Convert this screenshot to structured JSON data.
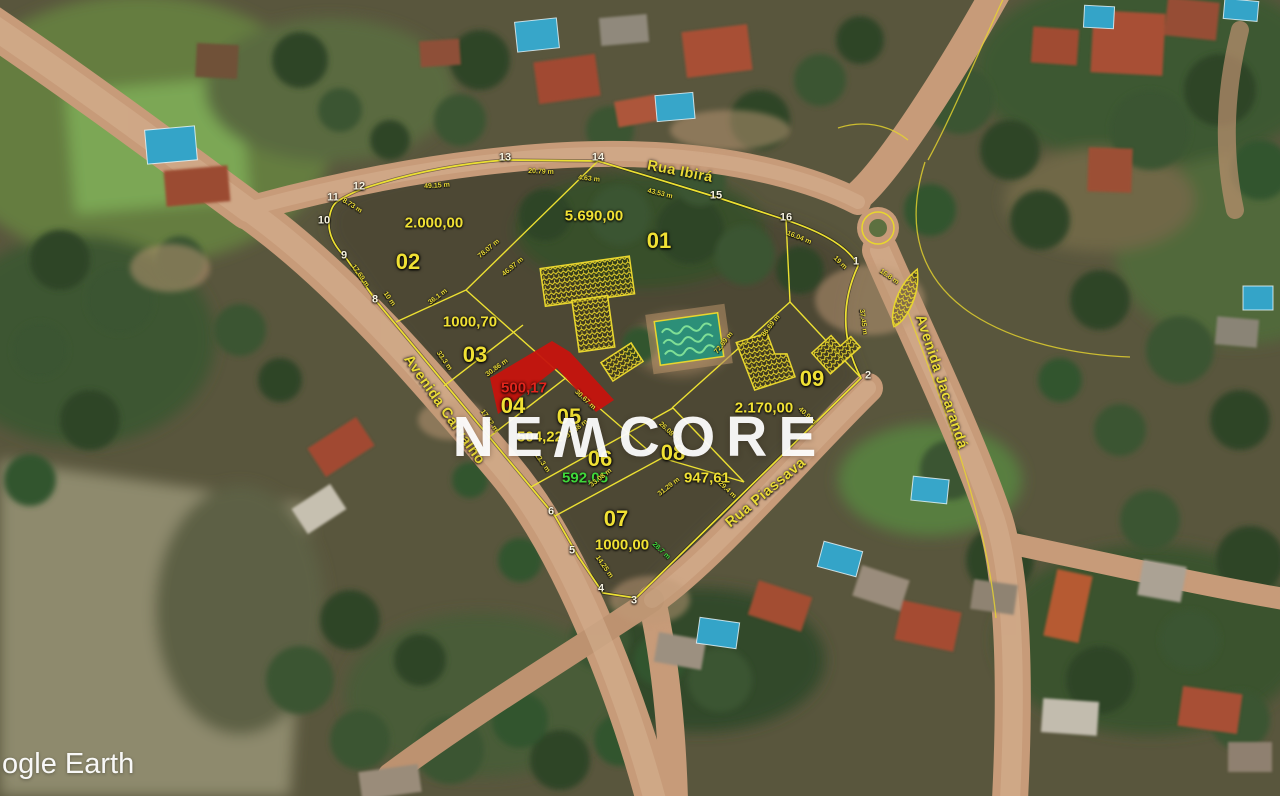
{
  "watermark": {
    "prefix": "NE",
    "flipped_letter": "W",
    "suffix": "CORE"
  },
  "attribution": {
    "logo_text": "ogle Earth"
  },
  "colors": {
    "lot_line": "#ece032",
    "lot_text": "#f0e134",
    "area_green": "#3fd83a",
    "area_red": "#e2251c",
    "highlight_red": "#c6140e",
    "street_text": "#e9da36"
  },
  "streets": [
    {
      "name": "Rua Ibirá",
      "x": 680,
      "y": 172,
      "rotation": 11
    },
    {
      "name": "Avenida Carvalho",
      "x": 444,
      "y": 410,
      "rotation": 55
    },
    {
      "name": "Avenida Jacarandá",
      "x": 941,
      "y": 382,
      "rotation": 72
    },
    {
      "name": "Rua Piassava",
      "x": 766,
      "y": 493,
      "rotation": -40
    }
  ],
  "lots": [
    {
      "number": "01",
      "area": "5.690,00",
      "number_pos": {
        "x": 659,
        "y": 241
      },
      "area_pos": {
        "x": 594,
        "y": 216
      },
      "area_color": "#f0e134"
    },
    {
      "number": "02",
      "area": "2.000,00",
      "number_pos": {
        "x": 408,
        "y": 262
      },
      "area_pos": {
        "x": 434,
        "y": 223
      },
      "area_color": "#f0e134"
    },
    {
      "number": "03",
      "area": "1000,70",
      "number_pos": {
        "x": 475,
        "y": 355
      },
      "area_pos": {
        "x": 470,
        "y": 322
      },
      "area_color": "#f0e134"
    },
    {
      "number": "04",
      "area": "500,17",
      "number_pos": {
        "x": 513,
        "y": 406
      },
      "area_pos": {
        "x": 524,
        "y": 388
      },
      "area_color": "#e2251c"
    },
    {
      "number": "05",
      "area": "504,22",
      "number_pos": {
        "x": 569,
        "y": 417
      },
      "area_pos": {
        "x": 540,
        "y": 437
      },
      "area_color": "#f0e134"
    },
    {
      "number": "06",
      "area": "592,05",
      "number_pos": {
        "x": 600,
        "y": 459
      },
      "area_pos": {
        "x": 585,
        "y": 478
      },
      "area_color": "#3fd83a"
    },
    {
      "number": "07",
      "area": "1000,00",
      "number_pos": {
        "x": 616,
        "y": 519
      },
      "area_pos": {
        "x": 622,
        "y": 545
      },
      "area_color": "#f0e134"
    },
    {
      "number": "08",
      "area": "947,61",
      "number_pos": {
        "x": 673,
        "y": 453
      },
      "area_pos": {
        "x": 707,
        "y": 478
      },
      "area_color": "#f0e134"
    },
    {
      "number": "09",
      "area": "2.170,00",
      "number_pos": {
        "x": 812,
        "y": 379
      },
      "area_pos": {
        "x": 764,
        "y": 408
      },
      "area_color": "#f0e134"
    }
  ],
  "vertices": [
    {
      "n": "1",
      "x": 856,
      "y": 262
    },
    {
      "n": "2",
      "x": 868,
      "y": 376
    },
    {
      "n": "3",
      "x": 634,
      "y": 601
    },
    {
      "n": "4",
      "x": 601,
      "y": 589
    },
    {
      "n": "5",
      "x": 572,
      "y": 551
    },
    {
      "n": "6",
      "x": 551,
      "y": 512
    },
    {
      "n": "8",
      "x": 375,
      "y": 300
    },
    {
      "n": "9",
      "x": 344,
      "y": 256
    },
    {
      "n": "10",
      "x": 324,
      "y": 221
    },
    {
      "n": "11",
      "x": 333,
      "y": 198
    },
    {
      "n": "12",
      "x": 359,
      "y": 187
    },
    {
      "n": "13",
      "x": 505,
      "y": 158
    },
    {
      "n": "14",
      "x": 598,
      "y": 158
    },
    {
      "n": "15",
      "x": 716,
      "y": 196
    },
    {
      "n": "16",
      "x": 786,
      "y": 218
    }
  ],
  "measurements": [
    {
      "text": "49.15 m",
      "x": 437,
      "y": 186,
      "rotation": -4
    },
    {
      "text": "20.79 m",
      "x": 541,
      "y": 172,
      "rotation": 2
    },
    {
      "text": "4.63 m",
      "x": 589,
      "y": 179,
      "rotation": 6
    },
    {
      "text": "43.53 m",
      "x": 660,
      "y": 194,
      "rotation": 14
    },
    {
      "text": "16.04 m",
      "x": 799,
      "y": 238,
      "rotation": 22
    },
    {
      "text": "19 m",
      "x": 840,
      "y": 263,
      "rotation": 45
    },
    {
      "text": "37.45 m",
      "x": 863,
      "y": 322,
      "rotation": 82
    },
    {
      "text": "8.73 m",
      "x": 352,
      "y": 206,
      "rotation": 32
    },
    {
      "text": "17.69 m",
      "x": 360,
      "y": 276,
      "rotation": 55
    },
    {
      "text": "10 m",
      "x": 389,
      "y": 299,
      "rotation": 55
    },
    {
      "text": "36.1 m",
      "x": 438,
      "y": 297,
      "rotation": -37
    },
    {
      "text": "78.07 m",
      "x": 489,
      "y": 249,
      "rotation": -40
    },
    {
      "text": "46.97 m",
      "x": 513,
      "y": 267,
      "rotation": -40
    },
    {
      "text": "33.3 m",
      "x": 444,
      "y": 361,
      "rotation": 55
    },
    {
      "text": "30.86 m",
      "x": 497,
      "y": 368,
      "rotation": -36
    },
    {
      "text": "17.22 m",
      "x": 489,
      "y": 421,
      "rotation": 55
    },
    {
      "text": "30.67 m",
      "x": 585,
      "y": 400,
      "rotation": 43
    },
    {
      "text": "31.08 m",
      "x": 577,
      "y": 429,
      "rotation": -38
    },
    {
      "text": "13.3 m",
      "x": 542,
      "y": 463,
      "rotation": 55
    },
    {
      "text": "33.08 m",
      "x": 601,
      "y": 478,
      "rotation": -38
    },
    {
      "text": "26.08 m",
      "x": 669,
      "y": 432,
      "rotation": 43
    },
    {
      "text": "31.29 m",
      "x": 669,
      "y": 487,
      "rotation": -38
    },
    {
      "text": "29.4 m",
      "x": 727,
      "y": 490,
      "rotation": 43
    },
    {
      "text": "14.25 m",
      "x": 604,
      "y": 567,
      "rotation": 55
    },
    {
      "text": "28.7 m",
      "x": 661,
      "y": 551,
      "rotation": 43,
      "color": "#3fd83a"
    },
    {
      "text": "72.69 m",
      "x": 724,
      "y": 343,
      "rotation": -52
    },
    {
      "text": "86.69 m",
      "x": 771,
      "y": 326,
      "rotation": -52
    },
    {
      "text": "40.9 m",
      "x": 807,
      "y": 416,
      "rotation": 43
    },
    {
      "text": "16.8 m",
      "x": 889,
      "y": 277,
      "rotation": 35
    }
  ]
}
